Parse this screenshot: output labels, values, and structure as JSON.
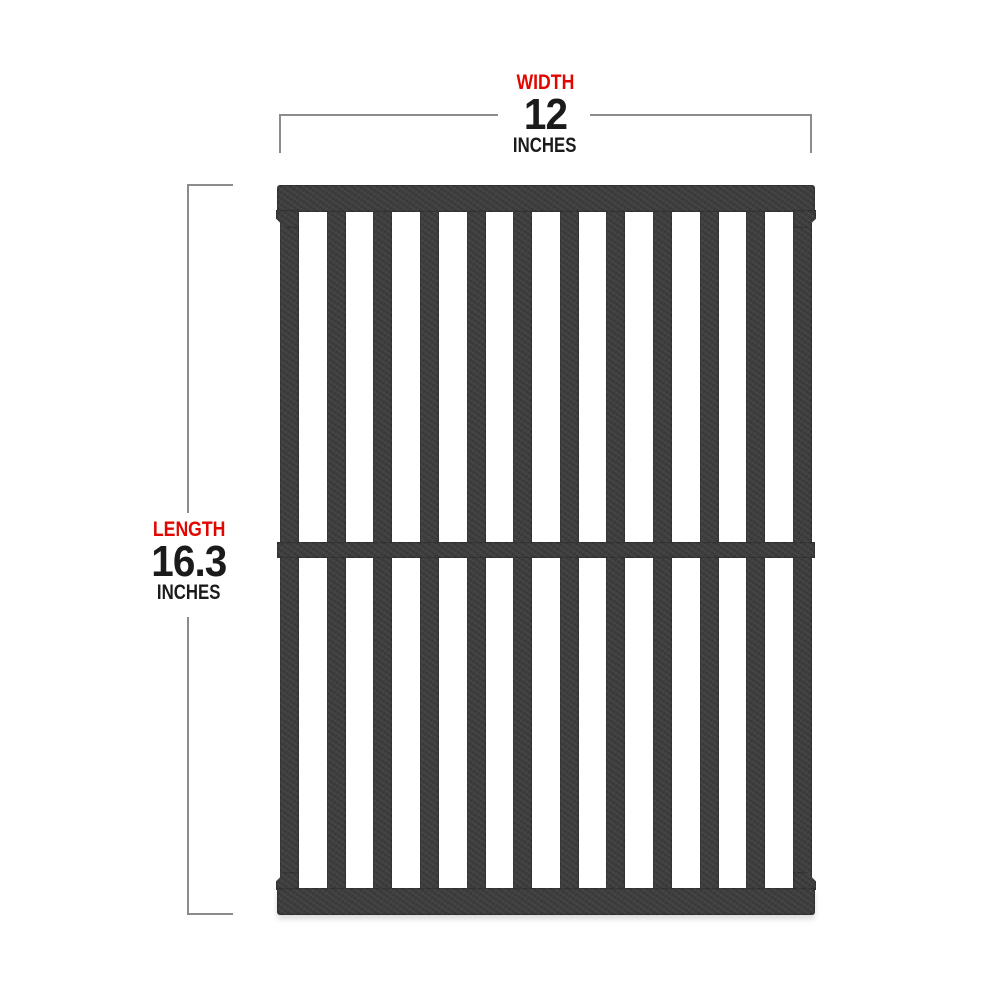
{
  "diagram": {
    "background_color": "#ffffff",
    "dimensions": {
      "width": {
        "label": "WIDTH",
        "value": "12",
        "unit": "INCHES"
      },
      "length": {
        "label": "LENGTH",
        "value": "16.3",
        "unit": "INCHES"
      }
    },
    "product_image": {
      "description": "black cast iron grill cooking grate, portrait orientation",
      "vertical_bar_count": 12,
      "cross_rails": [
        "top",
        "middle",
        "bottom"
      ]
    },
    "colors": {
      "label_red": "#e10600",
      "value_black": "#1b1b1b",
      "dimension_line_gray": "#8c8c8c",
      "grate_iron": "#3d3d3d"
    }
  }
}
